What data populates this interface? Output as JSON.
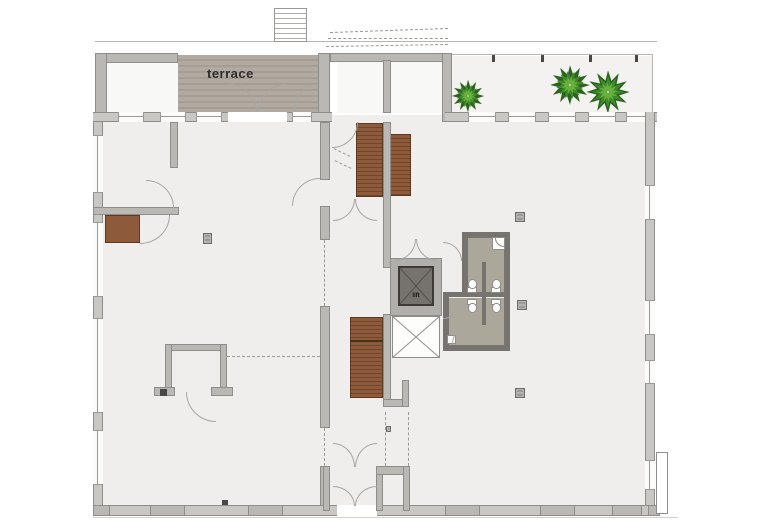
{
  "plan": {
    "title": "ground floor plan",
    "labels": {
      "terrace": "terrace",
      "lift": "lift"
    },
    "colors": {
      "wall": "#bab8b5",
      "wall_edge": "#8f8d8a",
      "wall_dark": "#77736f",
      "floor": "#efeeec",
      "floor_bright": "#f8f8f6",
      "balcony_floor": "#f3f2f0",
      "terrace_stripe_a": "#b2aaa1",
      "terrace_stripe_b": "#a69e95",
      "stair_tread": "#8d5a3b",
      "stair_riser": "#6f462a",
      "bath_floor": "#aba79b",
      "lift_cab": "#76726e",
      "plant_dark": "#2c641f",
      "plant_mid": "#3f8a2a",
      "plant_light": "#68b03e",
      "door_arc": "#a8a6a3",
      "dash": "#9b9996"
    },
    "icons": {
      "plant": "plant-icon",
      "toilet": "toilet-icon",
      "shower": "corner-shower-icon",
      "column": "column-marker",
      "stairs": "staircase",
      "lift_shaft": "shaft-x"
    }
  }
}
